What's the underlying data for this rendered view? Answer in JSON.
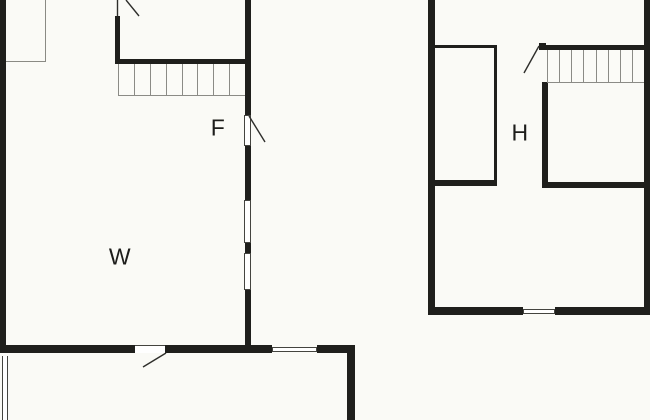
{
  "title": "two-storey floor plan",
  "rooms": {
    "f": "F",
    "w": "W",
    "h": "H"
  },
  "stairs": {
    "left_plan_treads": 8,
    "right_plan_treads": 8
  },
  "colors": {
    "background": "#fafaf6",
    "wall": "#1f1f1c",
    "stair_line": "#8b8b86",
    "frame_line": "#44443f",
    "door_swing_line": "#2e2e2b",
    "label_text": "#1d1d1b"
  }
}
